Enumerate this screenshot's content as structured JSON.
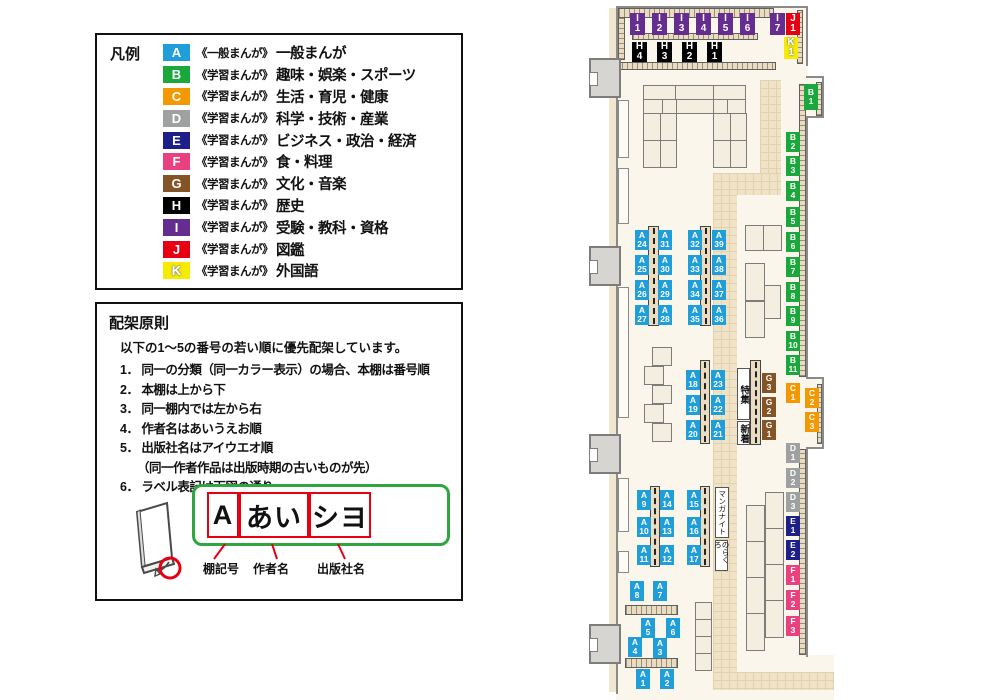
{
  "legend": {
    "title": "凡例",
    "items": [
      {
        "letter": "A",
        "color": "#1f9ed9",
        "series": "《一般まんが》",
        "label": "一般まんが"
      },
      {
        "letter": "B",
        "color": "#1aa83c",
        "series": "《学習まんが》",
        "label": "趣味・娯楽・スポーツ"
      },
      {
        "letter": "C",
        "color": "#f39800",
        "series": "《学習まんが》",
        "label": "生活・育児・健康"
      },
      {
        "letter": "D",
        "color": "#9fa0a0",
        "series": "《学習まんが》",
        "label": "科学・技術・産業"
      },
      {
        "letter": "E",
        "color": "#1d2088",
        "series": "《学習まんが》",
        "label": "ビジネス・政治・経済"
      },
      {
        "letter": "F",
        "color": "#e9417f",
        "series": "《学習まんが》",
        "label": "食・料理"
      },
      {
        "letter": "G",
        "color": "#855426",
        "series": "《学習まんが》",
        "label": "文化・音楽"
      },
      {
        "letter": "H",
        "color": "#000000",
        "series": "《学習まんが》",
        "label": "歴史"
      },
      {
        "letter": "I",
        "color": "#662d91",
        "series": "《学習まんが》",
        "label": "受験・教科・資格"
      },
      {
        "letter": "J",
        "color": "#e60012",
        "series": "《学習まんが》",
        "label": "図鑑"
      },
      {
        "letter": "K",
        "color": "#f7ec00",
        "series": "《学習まんが》",
        "label": "外国語",
        "outline": true
      }
    ]
  },
  "principles": {
    "title": "配架原則",
    "intro": "以下の1～5の番号の若い順に優先配架しています。",
    "rules": [
      {
        "num": "1．",
        "text": "同一の分類（同一カラー表示）の場合、本棚は番号順"
      },
      {
        "num": "2．",
        "text": "本棚は上から下"
      },
      {
        "num": "3．",
        "text": "同一棚内では左から右"
      },
      {
        "num": "4．",
        "text": "作者名はあいうえお順"
      },
      {
        "num": "5．",
        "text": "出版社名はアイウエオ順",
        "note": "（同一作者作品は出版時期の古いものが先）"
      },
      {
        "num": "6．",
        "text": "ラベル表記は下図の通り"
      }
    ]
  },
  "label_figure": {
    "boxes": [
      {
        "text": "A",
        "x": 12,
        "w": 32
      },
      {
        "text": "あい",
        "x": 44,
        "w": 70
      },
      {
        "text": "シヨ",
        "x": 114,
        "w": 62
      }
    ],
    "captions": [
      {
        "text": "棚記号",
        "x": 106
      },
      {
        "text": "作者名",
        "x": 156
      },
      {
        "text": "出版社名",
        "x": 220
      }
    ],
    "accent_green": "#2fa63f",
    "accent_red": "#e60012"
  },
  "map": {
    "colors": {
      "A": "#1f9ed9",
      "B": "#1aa83c",
      "C": "#f39800",
      "D": "#9fa0a0",
      "E": "#1d2088",
      "F": "#e9417f",
      "G": "#855426",
      "H": "#000000",
      "I": "#662d91",
      "J": "#e60012",
      "K": "#f7ec00"
    },
    "labels": [
      {
        "id": "I1",
        "x": 32,
        "y": 13,
        "w": 15,
        "h": 22,
        "big": true
      },
      {
        "id": "I2",
        "x": 54,
        "y": 13,
        "w": 15,
        "h": 22,
        "big": true
      },
      {
        "id": "I3",
        "x": 76,
        "y": 13,
        "w": 15,
        "h": 22,
        "big": true
      },
      {
        "id": "I4",
        "x": 98,
        "y": 13,
        "w": 15,
        "h": 22,
        "big": true
      },
      {
        "id": "I5",
        "x": 120,
        "y": 13,
        "w": 15,
        "h": 22,
        "big": true
      },
      {
        "id": "I6",
        "x": 142,
        "y": 13,
        "w": 15,
        "h": 22,
        "big": true
      },
      {
        "id": "I7",
        "x": 172,
        "y": 13,
        "w": 15,
        "h": 22,
        "big": true
      },
      {
        "id": "J1",
        "x": 188,
        "y": 13,
        "w": 14,
        "h": 22,
        "big": true
      },
      {
        "id": "K1",
        "x": 186,
        "y": 37,
        "w": 14,
        "h": 22,
        "big": true
      },
      {
        "id": "H4",
        "x": 34,
        "y": 42,
        "w": 15,
        "h": 20,
        "big": true
      },
      {
        "id": "H3",
        "x": 59,
        "y": 42,
        "w": 15,
        "h": 20,
        "big": true
      },
      {
        "id": "H2",
        "x": 84,
        "y": 42,
        "w": 15,
        "h": 20,
        "big": true
      },
      {
        "id": "H1",
        "x": 109,
        "y": 42,
        "w": 15,
        "h": 20,
        "big": true
      },
      {
        "id": "B1",
        "x": 206,
        "y": 84,
        "w": 14,
        "h": 26
      },
      {
        "id": "B2",
        "x": 188,
        "y": 132
      },
      {
        "id": "B3",
        "x": 188,
        "y": 156
      },
      {
        "id": "B4",
        "x": 188,
        "y": 181
      },
      {
        "id": "B5",
        "x": 188,
        "y": 207
      },
      {
        "id": "B6",
        "x": 188,
        "y": 232
      },
      {
        "id": "B7",
        "x": 188,
        "y": 257
      },
      {
        "id": "B8",
        "x": 188,
        "y": 282
      },
      {
        "id": "B9",
        "x": 188,
        "y": 306
      },
      {
        "id": "B10",
        "x": 188,
        "y": 331
      },
      {
        "id": "B11",
        "x": 188,
        "y": 355
      },
      {
        "id": "C1",
        "x": 188,
        "y": 383
      },
      {
        "id": "C2",
        "x": 207,
        "y": 388
      },
      {
        "id": "C3",
        "x": 207,
        "y": 412
      },
      {
        "id": "D1",
        "x": 188,
        "y": 443
      },
      {
        "id": "D2",
        "x": 188,
        "y": 468
      },
      {
        "id": "D3",
        "x": 188,
        "y": 492
      },
      {
        "id": "E1",
        "x": 188,
        "y": 516
      },
      {
        "id": "E2",
        "x": 188,
        "y": 540
      },
      {
        "id": "F1",
        "x": 188,
        "y": 565
      },
      {
        "id": "F2",
        "x": 188,
        "y": 590
      },
      {
        "id": "F3",
        "x": 188,
        "y": 616
      },
      {
        "id": "G3",
        "x": 164,
        "y": 373
      },
      {
        "id": "G2",
        "x": 164,
        "y": 397
      },
      {
        "id": "G1",
        "x": 164,
        "y": 420
      },
      {
        "id": "A24",
        "x": 37,
        "y": 230
      },
      {
        "id": "A31",
        "x": 60,
        "y": 230
      },
      {
        "id": "A32",
        "x": 90,
        "y": 230
      },
      {
        "id": "A39",
        "x": 114,
        "y": 230
      },
      {
        "id": "A25",
        "x": 37,
        "y": 255
      },
      {
        "id": "A30",
        "x": 60,
        "y": 255
      },
      {
        "id": "A33",
        "x": 90,
        "y": 255
      },
      {
        "id": "A38",
        "x": 114,
        "y": 255
      },
      {
        "id": "A26",
        "x": 37,
        "y": 280
      },
      {
        "id": "A29",
        "x": 60,
        "y": 280
      },
      {
        "id": "A34",
        "x": 90,
        "y": 280
      },
      {
        "id": "A37",
        "x": 114,
        "y": 280
      },
      {
        "id": "A27",
        "x": 37,
        "y": 305
      },
      {
        "id": "A28",
        "x": 60,
        "y": 305
      },
      {
        "id": "A35",
        "x": 90,
        "y": 305
      },
      {
        "id": "A36",
        "x": 114,
        "y": 305
      },
      {
        "id": "A18",
        "x": 88,
        "y": 370
      },
      {
        "id": "A23",
        "x": 113,
        "y": 370
      },
      {
        "id": "A19",
        "x": 88,
        "y": 395
      },
      {
        "id": "A22",
        "x": 113,
        "y": 395
      },
      {
        "id": "A20",
        "x": 88,
        "y": 420
      },
      {
        "id": "A21",
        "x": 113,
        "y": 420
      },
      {
        "id": "A9",
        "x": 39,
        "y": 490
      },
      {
        "id": "A14",
        "x": 62,
        "y": 490
      },
      {
        "id": "A15",
        "x": 89,
        "y": 490
      },
      {
        "id": "A10",
        "x": 39,
        "y": 517
      },
      {
        "id": "A13",
        "x": 62,
        "y": 517
      },
      {
        "id": "A16",
        "x": 89,
        "y": 517
      },
      {
        "id": "A11",
        "x": 39,
        "y": 545
      },
      {
        "id": "A12",
        "x": 62,
        "y": 545
      },
      {
        "id": "A17",
        "x": 89,
        "y": 545
      },
      {
        "id": "A8",
        "x": 32,
        "y": 581
      },
      {
        "id": "A7",
        "x": 55,
        "y": 581
      },
      {
        "id": "A5",
        "x": 43,
        "y": 618
      },
      {
        "id": "A6",
        "x": 68,
        "y": 618
      },
      {
        "id": "A4",
        "x": 30,
        "y": 637
      },
      {
        "id": "A3",
        "x": 55,
        "y": 638
      },
      {
        "id": "A1",
        "x": 38,
        "y": 669
      },
      {
        "id": "A2",
        "x": 62,
        "y": 669
      }
    ],
    "notes": [
      {
        "text": "特集",
        "x": 139,
        "y": 368,
        "w": 13,
        "h": 52,
        "small": false
      },
      {
        "text": "新着",
        "x": 139,
        "y": 421,
        "w": 13,
        "h": 24,
        "small": false
      },
      {
        "text": "マンガナイト",
        "x": 117,
        "y": 487,
        "w": 14,
        "h": 51,
        "small": true
      },
      {
        "text": "のらくろ",
        "x": 117,
        "y": 540,
        "w": 13,
        "h": 31,
        "small": true
      }
    ]
  }
}
